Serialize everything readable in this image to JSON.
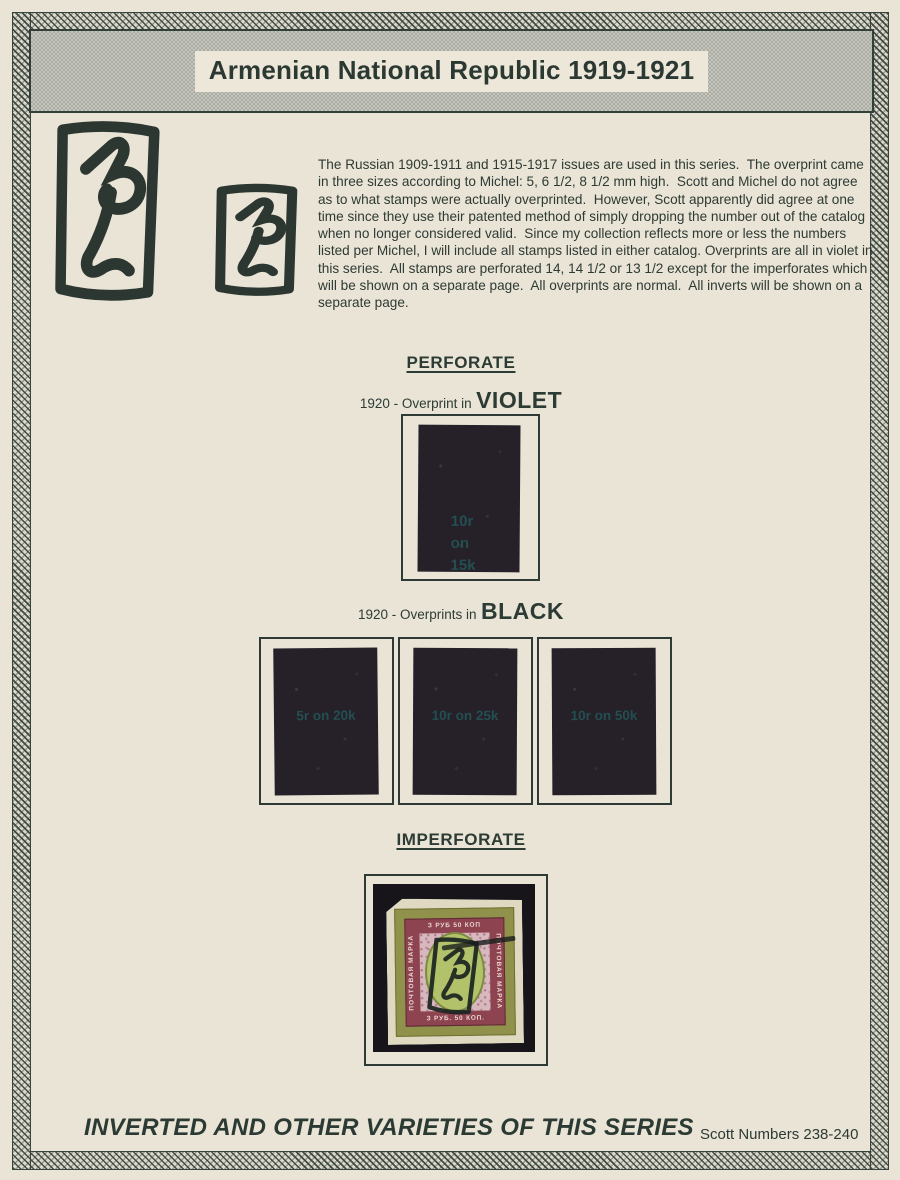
{
  "header": {
    "title": "Armenian National Republic 1919-1921"
  },
  "intro": {
    "text": "The Russian 1909-1911 and 1915-1917 issues are used in this series.  The overprint came in three sizes according to Michel: 5, 6 1/2, 8 1/2 mm high.  Scott and Michel do not agree as to what stamps were actually overprinted.  However, Scott apparently did agree at one time since they use their patented method of simply dropping the number out of the catalog when no longer considered valid.  Since my collection reflects more or less the numbers listed per Michel, I will include all stamps listed in either catalog. Overprints are all in violet in this series.  All stamps are perforated 14, 14 1/2 or 13 1/2 except for the imperforates which will be shown on a separate page.  All overprints are normal.  All inverts will be shown on a separate page."
  },
  "perforate": {
    "heading": "PERFORATE",
    "violet_group": {
      "year_prefix": "1920  - Overprint in",
      "color_word": "VIOLET",
      "stamp": {
        "surcharge_lines": [
          "10r",
          "on",
          "15k"
        ]
      }
    },
    "black_group": {
      "year_prefix": "1920  - Overprints in",
      "color_word": "BLACK",
      "stamps": [
        {
          "surcharge": "5r on 20k"
        },
        {
          "surcharge": "10r on 25k"
        },
        {
          "surcharge": "10r on 50k"
        }
      ]
    }
  },
  "imperforate": {
    "heading": "IMPERFORATE",
    "stamp": {
      "top_label": "З РУБ 50 КОП",
      "bottom_label": "З РУБ. 50 КОП.",
      "left_label": "ПОЧТОВАЯ МАРКА",
      "right_label": "ПОЧТОВАЯ МАРКА"
    }
  },
  "footer": {
    "caption": "INVERTED AND OTHER VARIETIES OF THIS SERIES",
    "scott_numbers": "Scott Numbers 238-240"
  },
  "colors": {
    "paper": "#e9e4d6",
    "ink": "#2d3b35",
    "border_hatch": "#38463e",
    "title_band": "#b4b7ae",
    "stamp_dark": "#262029",
    "surcharge_teal": "#215c5c",
    "photo_black": "#17141a",
    "stamp_olive": "#90914a",
    "stamp_maroon": "#8d4350",
    "stamp_pink": "#d7b8bf",
    "stamp_green": "#b2c26b"
  }
}
